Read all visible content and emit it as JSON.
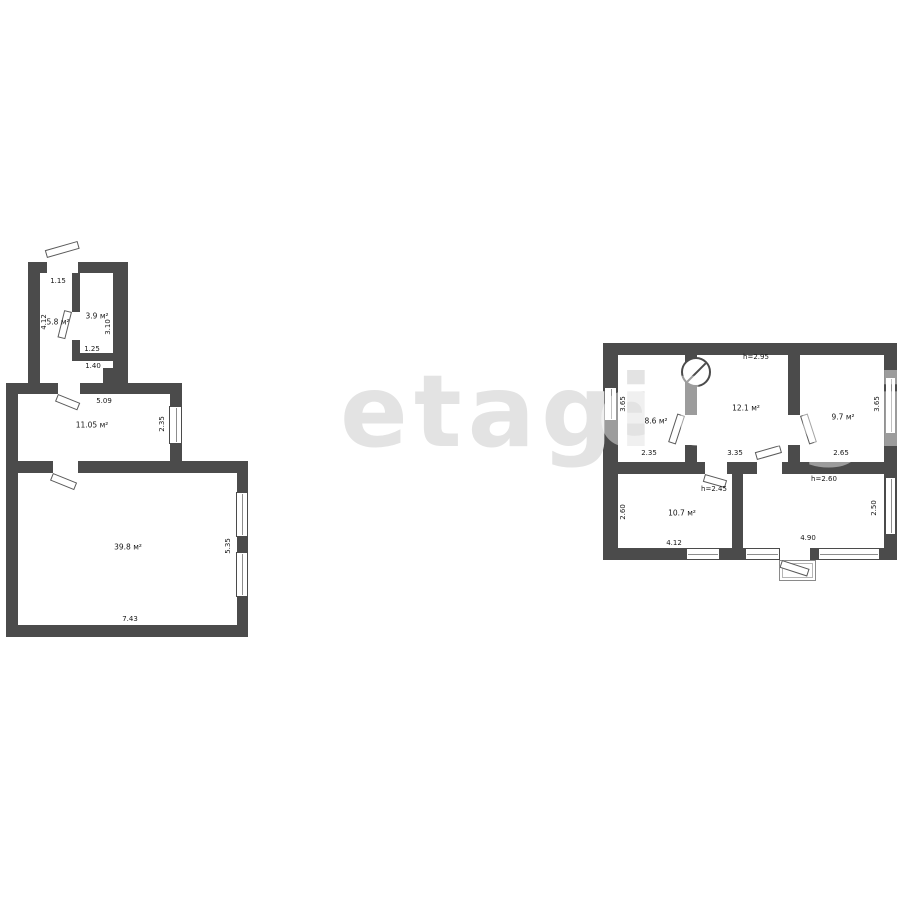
{
  "watermark": {
    "text": "etagi"
  },
  "colors": {
    "wall": "#4b4b4b",
    "background": "#ffffff",
    "watermark": "#e3e3e3"
  },
  "left_plan": {
    "rooms": {
      "room1": {
        "area": "5.8 м²",
        "width": "1.15",
        "height": "4.12"
      },
      "room2": {
        "area": "3.9 м²",
        "width": "1.25",
        "height": "3.10",
        "width2": "1.40"
      },
      "room3": {
        "area": "11.05 м²",
        "width": "5.09",
        "height": "2.35"
      },
      "room4": {
        "area": "39.8 м²",
        "width": "7.43",
        "height": "5.35"
      }
    }
  },
  "right_plan": {
    "rooms": {
      "roomA": {
        "area": "8.6 м²",
        "width": "2.35",
        "height": "3.65"
      },
      "roomB": {
        "area": "12.1 м²",
        "width": "3.35",
        "ceiling_height": "h=2.95"
      },
      "roomC": {
        "area": "9.7 м²",
        "width": "2.65",
        "height": "3.65"
      },
      "roomD": {
        "area": "10.7 м²",
        "width": "4.12",
        "height": "2.60",
        "ceiling_height": "h=2.45"
      },
      "roomE": {
        "width": "4.90",
        "height": "2.50",
        "ceiling_height": "h=2.60"
      }
    }
  }
}
